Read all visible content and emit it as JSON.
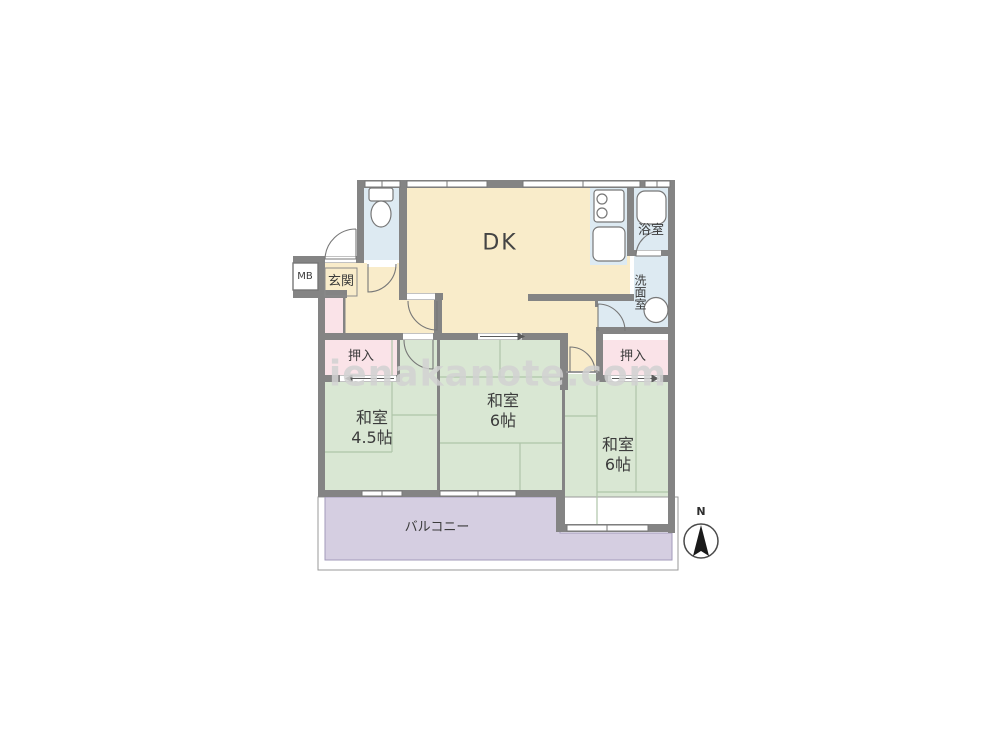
{
  "floorplan": {
    "watermark": "ienakanote.com",
    "compass": {
      "north_label": "N"
    },
    "labels": {
      "meter_box": "MB",
      "entrance": "玄関",
      "dining_kitchen": "DK",
      "bathroom": "浴室",
      "washroom": "洗面室",
      "closet_left": "押入",
      "closet_right": "押入",
      "balcony": "バルコニー",
      "japanese_room_45": {
        "name": "和室",
        "size": "4.5帖"
      },
      "japanese_room_6_center": {
        "name": "和室",
        "size": "6帖"
      },
      "japanese_room_6_right": {
        "name": "和室",
        "size": "6帖"
      }
    },
    "colors": {
      "wall": "#848484",
      "dk_floor": "#f9ecca",
      "tatami_room": "#d9e7d3",
      "closet": "#fae3e8",
      "wet_area": "#ddeaf2",
      "balcony": "#d5cee1",
      "watermark_color": "#d2d2d2"
    }
  }
}
